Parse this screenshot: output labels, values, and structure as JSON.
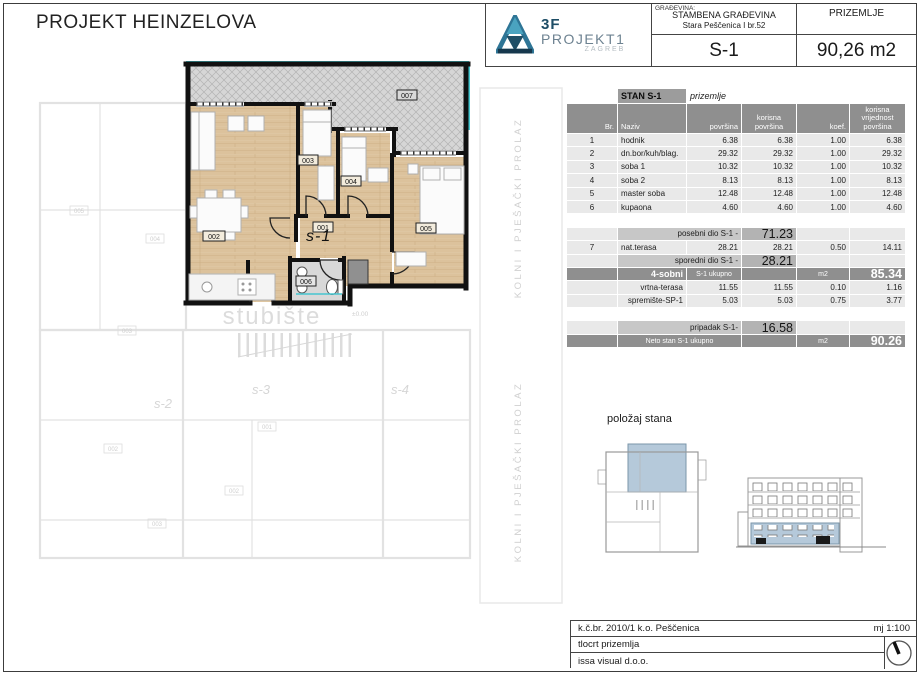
{
  "sheet": {
    "title": "PROJEKT HEINZELOVA"
  },
  "header": {
    "logo": {
      "brand": "3F",
      "name": "PROJEKT1",
      "city": "ZAGREB"
    },
    "building_label": "GRAĐEVINA:",
    "building_name": "STAMBENA GRAĐEVINA",
    "building_address": "Stara Peščenica I br.52",
    "floor": "PRIZEMLJE",
    "unit": "S-1",
    "unit_area": "90,26 m2"
  },
  "plan": {
    "unit_label": "s-1",
    "room_labels": [
      "001",
      "002",
      "003",
      "004",
      "005",
      "006",
      "007"
    ],
    "background": {
      "stairs": "stubište",
      "unit_labels": [
        "s-2",
        "s-3",
        "s-4"
      ],
      "corridor": "KOLNI I PJEŠAČKI PROLAZ",
      "elevation": "±0.00",
      "room_labels": [
        "005",
        "004",
        "003",
        "002",
        "001",
        "002",
        "003"
      ]
    }
  },
  "position": {
    "title": "položaj stana"
  },
  "area_table": {
    "col_widths": [
      50,
      68,
      54,
      54,
      52,
      55
    ],
    "rows": [
      {
        "h": 14,
        "cells": [
          {
            "s": ""
          },
          {
            "t": "STAN S-1",
            "s": "stan"
          },
          {
            "t": "prizemlje",
            "s": "priz"
          },
          {
            "s": ""
          },
          {
            "s": ""
          },
          {
            "s": ""
          }
        ]
      },
      {
        "h": 29,
        "cells": [
          {
            "t": "Br.",
            "s": "h hR"
          },
          {
            "t": "Naziv",
            "s": "h hL"
          },
          {
            "t": "površina",
            "s": "h hR"
          },
          {
            "t": "korisna površina",
            "s": "h hC"
          },
          {
            "t": "koef.",
            "s": "h hR"
          },
          {
            "t": "korisna vrijednost površina",
            "s": "h hC"
          }
        ]
      },
      {
        "cells": [
          {
            "t": "1",
            "s": "g gC"
          },
          {
            "t": "hodnik",
            "s": "g gL"
          },
          {
            "t": "6.38",
            "s": "g gR"
          },
          {
            "t": "6.38",
            "s": "g gR"
          },
          {
            "t": "1.00",
            "s": "g gR"
          },
          {
            "t": "6.38",
            "s": "g gR"
          }
        ]
      },
      {
        "cells": [
          {
            "t": "2",
            "s": "g gC"
          },
          {
            "t": "dn.bor/kuh/blag.",
            "s": "g gL"
          },
          {
            "t": "29.32",
            "s": "g gR"
          },
          {
            "t": "29.32",
            "s": "g gR"
          },
          {
            "t": "1.00",
            "s": "g gR"
          },
          {
            "t": "29.32",
            "s": "g gR"
          }
        ]
      },
      {
        "cells": [
          {
            "t": "3",
            "s": "g gC"
          },
          {
            "t": "soba 1",
            "s": "g gL"
          },
          {
            "t": "10.32",
            "s": "g gR"
          },
          {
            "t": "10.32",
            "s": "g gR"
          },
          {
            "t": "1.00",
            "s": "g gR"
          },
          {
            "t": "10.32",
            "s": "g gR"
          }
        ]
      },
      {
        "cells": [
          {
            "t": "4",
            "s": "g gC"
          },
          {
            "t": "soba 2",
            "s": "g gL"
          },
          {
            "t": "8.13",
            "s": "g gR"
          },
          {
            "t": "8.13",
            "s": "g gR"
          },
          {
            "t": "1.00",
            "s": "g gR"
          },
          {
            "t": "8.13",
            "s": "g gR"
          }
        ]
      },
      {
        "cells": [
          {
            "t": "5",
            "s": "g gC"
          },
          {
            "t": "master soba",
            "s": "g gL"
          },
          {
            "t": "12.48",
            "s": "g gR"
          },
          {
            "t": "12.48",
            "s": "g gR"
          },
          {
            "t": "1.00",
            "s": "g gR"
          },
          {
            "t": "12.48",
            "s": "g gR"
          }
        ]
      },
      {
        "cells": [
          {
            "t": "6",
            "s": "g gC"
          },
          {
            "t": "kupaona",
            "s": "g gL"
          },
          {
            "t": "4.60",
            "s": "g gR"
          },
          {
            "t": "4.60",
            "s": "g gR"
          },
          {
            "t": "1.00",
            "s": "g gR"
          },
          {
            "t": "4.60",
            "s": "g gR"
          }
        ]
      },
      {
        "cells": [
          {
            "s": ""
          },
          {
            "s": ""
          },
          {
            "s": ""
          },
          {
            "s": ""
          },
          {
            "s": ""
          },
          {
            "s": ""
          }
        ]
      },
      {
        "cells": [
          {
            "s": "g"
          },
          {
            "t": "posebni dio S-1 -",
            "s": "sub",
            "span": 2
          },
          {
            "t": "71.23",
            "s": "subv"
          },
          {
            "s": "g"
          },
          {
            "s": "g"
          }
        ]
      },
      {
        "cells": [
          {
            "t": "7",
            "s": "g gC"
          },
          {
            "t": "nat.terasa",
            "s": "g gL"
          },
          {
            "t": "28.21",
            "s": "g gR"
          },
          {
            "t": "28.21",
            "s": "g gR"
          },
          {
            "t": "0.50",
            "s": "g gR"
          },
          {
            "t": "14.11",
            "s": "g gR"
          }
        ]
      },
      {
        "cells": [
          {
            "s": "g"
          },
          {
            "t": "sporedni dio S-1 -",
            "s": "sub",
            "span": 2
          },
          {
            "t": "28.21",
            "s": "subv"
          },
          {
            "s": "g"
          },
          {
            "s": "g"
          }
        ]
      },
      {
        "cells": [
          {
            "s": "d"
          },
          {
            "t": "4-sobni",
            "s": "d dR"
          },
          {
            "t": "S-1 ukupno",
            "s": "d dC"
          },
          {
            "s": "d"
          },
          {
            "t": "m2",
            "s": "d dC"
          },
          {
            "t": "85.34",
            "s": "d dV"
          }
        ]
      },
      {
        "cells": [
          {
            "s": "g"
          },
          {
            "t": "vrtna-terasa",
            "s": "g gR"
          },
          {
            "t": "11.55",
            "s": "g gR"
          },
          {
            "t": "11.55",
            "s": "g gR"
          },
          {
            "t": "0.10",
            "s": "g gR"
          },
          {
            "t": "1.16",
            "s": "g gR"
          }
        ]
      },
      {
        "cells": [
          {
            "s": "g"
          },
          {
            "t": "spremište-SP-1",
            "s": "g gR"
          },
          {
            "t": "5.03",
            "s": "g gR"
          },
          {
            "t": "5.03",
            "s": "g gR"
          },
          {
            "t": "0.75",
            "s": "g gR"
          },
          {
            "t": "3.77",
            "s": "g gR"
          }
        ]
      },
      {
        "cells": [
          {
            "s": ""
          },
          {
            "s": ""
          },
          {
            "s": ""
          },
          {
            "s": ""
          },
          {
            "s": ""
          },
          {
            "s": ""
          }
        ]
      },
      {
        "cells": [
          {
            "s": "g"
          },
          {
            "t": "pripadak S-1-",
            "s": "sub",
            "span": 2
          },
          {
            "t": "16.58",
            "s": "subv"
          },
          {
            "s": "g"
          },
          {
            "s": "g"
          }
        ]
      },
      {
        "cells": [
          {
            "s": "d"
          },
          {
            "t": "Neto stan S-1 ukupno",
            "s": "d dC",
            "span": 2
          },
          {
            "s": "d"
          },
          {
            "t": "m2",
            "s": "d dC"
          },
          {
            "t": "90.26",
            "s": "d dV"
          }
        ]
      }
    ]
  },
  "title_block": {
    "parcel": "k.č.br. 2010/1 k.o. Peščenica",
    "scale": "mj 1:100",
    "drawing": "tlocrt prizemlja",
    "company": "issa visual d.o.o."
  },
  "colors": {
    "accent_cyan": "#45c6cf",
    "highlight_blue": "#b5c9da",
    "wall": "#111111",
    "wood": "#dcc29c"
  }
}
